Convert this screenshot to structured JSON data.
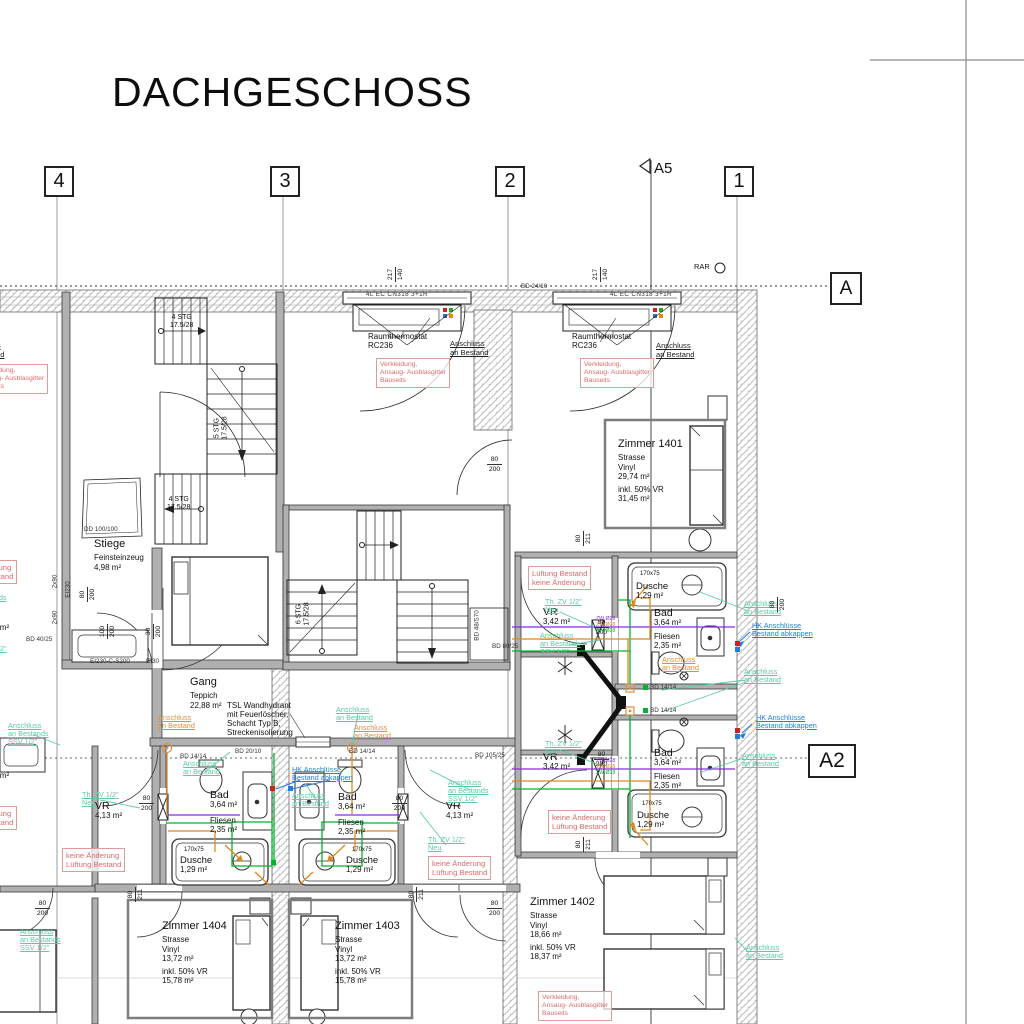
{
  "title": "DACHGESCHOSS",
  "colors": {
    "annotation_red": "#d96a6a",
    "annotation_teal": "#5cc9a4",
    "annotation_orange": "#d99040",
    "annotation_blue": "#1f7fe0",
    "pipe_green": "#00b42d",
    "pipe_orange": "#e08820",
    "pipe_purple": "#8a2be2",
    "wall_gray": "#b0b0b0"
  },
  "grid": {
    "g4": "4",
    "g3": "3",
    "g2": "2",
    "g1": "1",
    "a5": "A5",
    "section_a": "A",
    "section_a2": "A2",
    "rar": "RAR"
  },
  "rooms": {
    "stiege": {
      "name": "Stiege",
      "floor": "Feinsteinzeug",
      "area": "4,98 m²"
    },
    "gang": {
      "name": "Gang",
      "floor": "Teppich",
      "area": "22,88 m²"
    },
    "z1401": {
      "name": "Zimmer 1401",
      "street": "Strasse",
      "finish": "Vinyl",
      "area": "29,74 m²",
      "incl": "inkl. 50% VR",
      "area_incl": "31,45 m²"
    },
    "z1402": {
      "name": "Zimmer 1402",
      "street": "Strasse",
      "finish": "Vinyl",
      "area": "18,66 m²",
      "incl": "inkl. 50% VR",
      "area_incl": "18,37 m²"
    },
    "z1403": {
      "name": "Zimmer 1403",
      "street": "Strasse",
      "finish": "Vinyl",
      "area": "13,72 m²",
      "incl": "inkl. 50% VR",
      "area_incl": "15,78 m²"
    },
    "z1404": {
      "name": "Zimmer 1404",
      "street": "Strasse",
      "finish": "Vinyl",
      "area": "13,72 m²",
      "incl": "inkl. 50% VR",
      "area_incl": "15,78 m²"
    },
    "bad": {
      "name": "Bad",
      "area": "3,64 m²"
    },
    "fliesen": {
      "name": "Fliesen",
      "area": "2,35 m²"
    },
    "dusche": {
      "name": "Dusche",
      "area": "1,29 m²",
      "size": "170x75"
    },
    "vr413": {
      "name": "VR",
      "area": "4,13 m²"
    },
    "vr342": {
      "name": "VR",
      "area": "3,42 m²"
    },
    "vr447": {
      "name": "VR",
      "area": "4,47 m²"
    }
  },
  "stairs": {
    "run4": "4 STG",
    "run5": "5 STG",
    "run6": "6 STG",
    "rise": "17.5/28"
  },
  "annot": {
    "anschluss1": "Anschluss",
    "anschluss2": "an Bestand",
    "ssv1": "Anschluss",
    "ssv2": "an Bestands",
    "ssv3": "SSV 1/2\"",
    "hk1": "HK Anschlüsse",
    "hk2": "Bestand abkappen",
    "thzv1": "Th. ZV 1/2\"",
    "thzv2": "Neu",
    "verk1": "Verkleidung,",
    "verk2": "Ansaug- Ausblasgitter",
    "verk3": "Bauseits",
    "luft1": "Lüftung Bestand",
    "luft2": "keine Änderung",
    "ka1": "keine Änderung",
    "ka2": "Lüftung Bestand",
    "therm1": "Raumthermostat",
    "therm2": "RC236",
    "tsl1": "TSL Wandhydrant",
    "tsl2": "mit Feuerlöscher,",
    "tsl3": "Schacht Typ B,",
    "tsl4": "Streckenisolierung",
    "cn318": "4L EC CN318 3+1R",
    "zw": "ZW Ø28"
  },
  "dims": {
    "d217": "217",
    "d140": "140",
    "d80": "80",
    "d211": "211",
    "d200": "200",
    "d100": "100",
    "d30": "30",
    "bd2410": "BD 24/10",
    "bd1414": "BD 14/14",
    "bd2010": "BD 20/10",
    "bd4025": "BD 40/25",
    "bd10525": "BD 105/25",
    "bd8025": "BD 80/25",
    "bd48s70": "BD 48/S70",
    "dd100": "DD 100/100",
    "ei230": "EI230",
    "ei230c": "EI230-C-S200",
    "ei30": "EI30",
    "x90": "2x90"
  }
}
